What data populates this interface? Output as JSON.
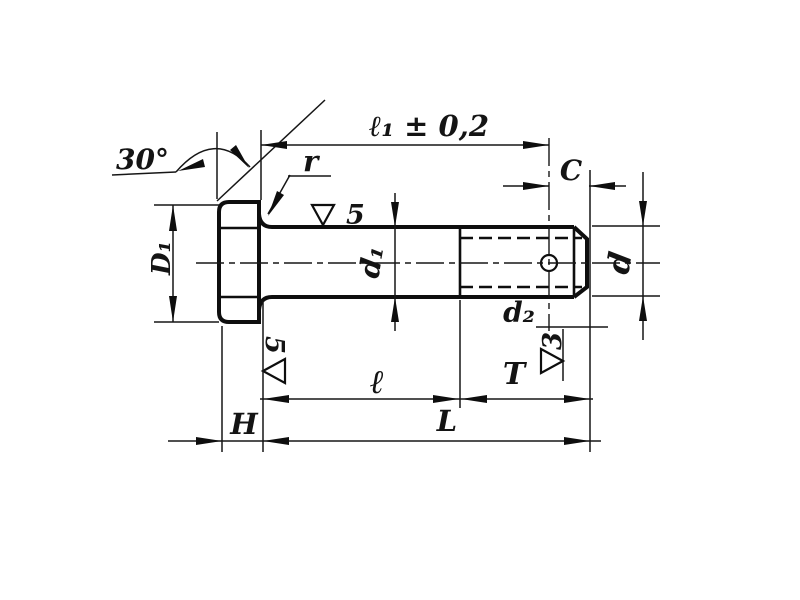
{
  "drawing": {
    "labels": {
      "angle": "30°",
      "radius": "r",
      "length_to_hole": "ℓ₁ ± 0,2",
      "tip_chamfer": "C",
      "head_diameter": "D₁",
      "shank_diameter": "d₁",
      "nominal_diameter": "d",
      "hole_diameter": "d₂",
      "grip_length": "ℓ",
      "thread_length": "T",
      "head_height": "H",
      "total_length": "L"
    },
    "surface_finish": {
      "shank_top": {
        "digit": "5",
        "mark": "∇5"
      },
      "under_head": {
        "digit": "5",
        "mark": "∇5"
      },
      "hole": {
        "digit": "3",
        "mark": "∇3"
      }
    }
  }
}
